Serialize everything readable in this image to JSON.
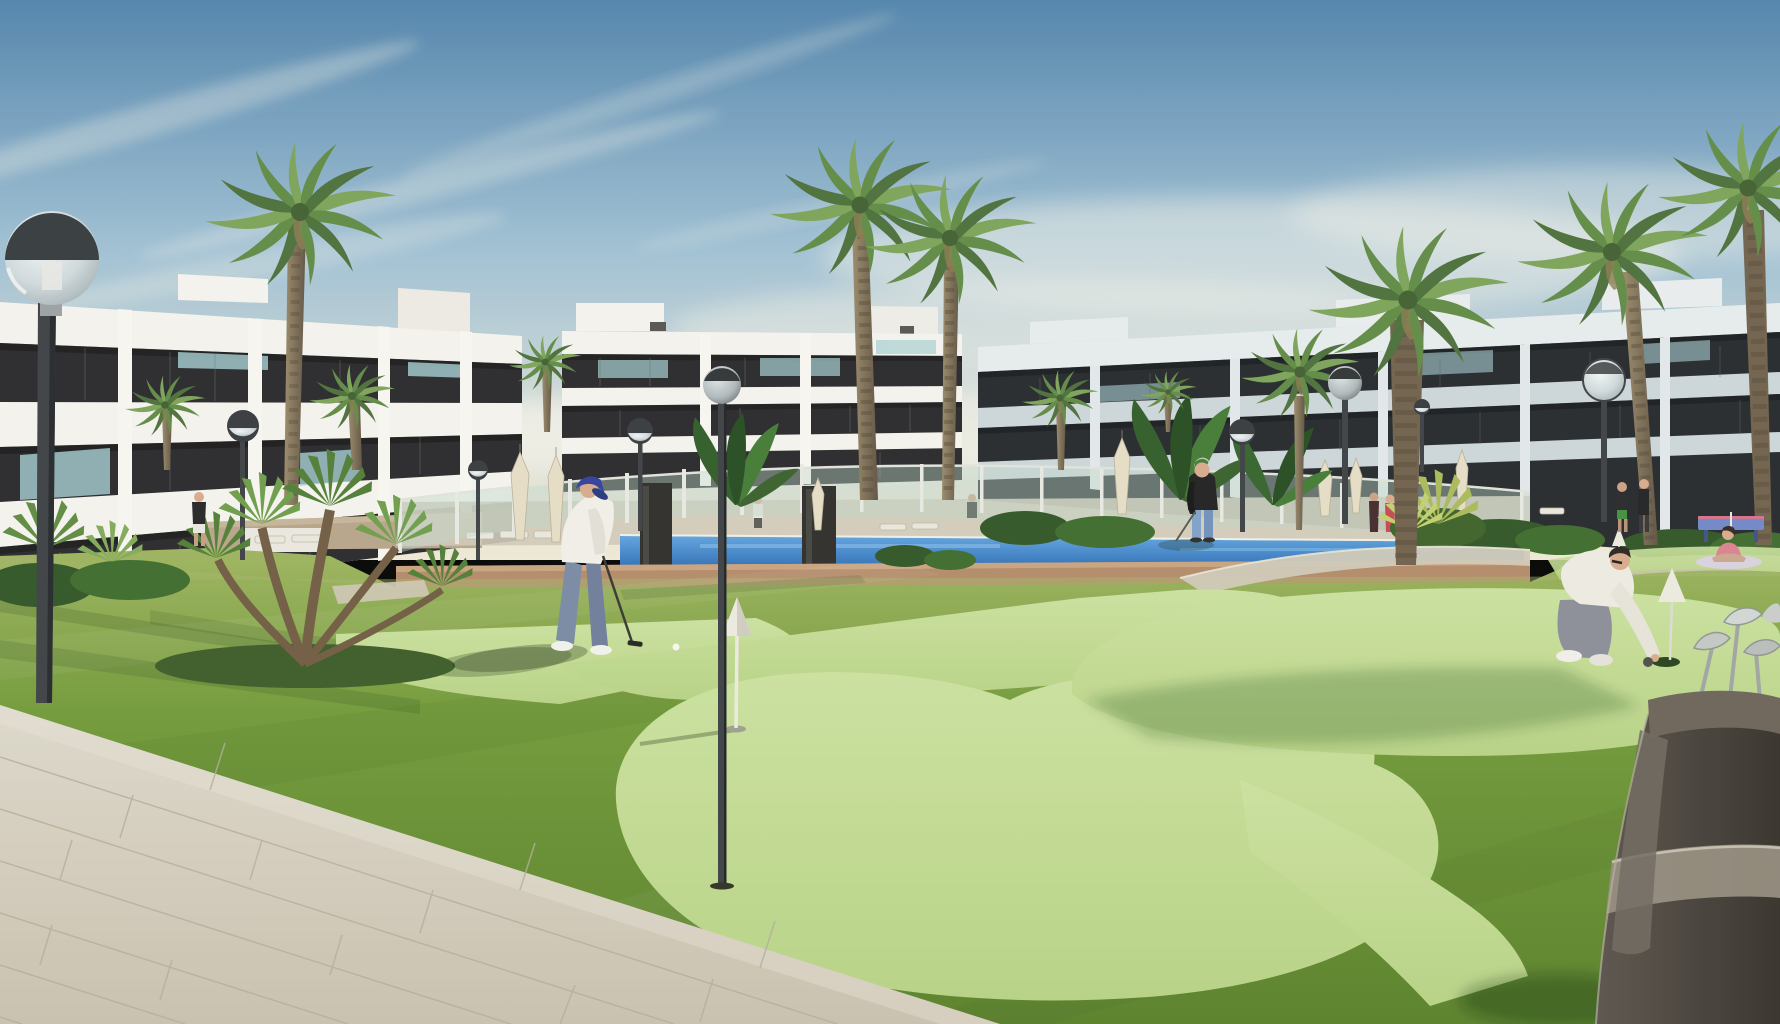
{
  "scene": {
    "kind": "architectural-render",
    "subject": "modern white apartment complex with communal putting green, pool area, palm trees and residents playing golf",
    "time_of_day": "late afternoon, clear sky"
  },
  "palette": {
    "sky_top": "#4f82ab",
    "sky_mid": "#9fc0d4",
    "sky_low": "#d9ded6",
    "sky_horizon": "#efe9d6",
    "cloud": "#f2f1e8",
    "building_white": "#f4f3ee",
    "building_right_light": "#ccd5da",
    "building_right_parapet": "#e6ebee",
    "glazing_dark": "#26262a",
    "glazing_deep": "#17181a",
    "balcony_teal": "#a5ced2",
    "grass_far": "#9db35e",
    "grass_mid": "#6f9836",
    "grass_near": "#577f28",
    "green_light_a": "#cbe19e",
    "green_light_b": "#b6d284",
    "pool_top": "#5fa2de",
    "pool_deep": "#2a6cb6",
    "deck_terracotta": "#b28a68",
    "path_light": "#d0c9b8",
    "pavement_far": "#ddd8cb",
    "pavement_near": "#c9c0ae",
    "tile_joint": "#b4ab99",
    "fence_glass": "#bed7c8",
    "fence_post": "#e6e8e2",
    "shower_slab": "#2c2b28",
    "trunk": "#83745a",
    "trunk_dark": "#5e5140",
    "frond_dark": "#4a6e38",
    "frond_mid": "#5f8a44",
    "frond_light": "#7ba357",
    "hedge": "#2e5423",
    "lamp_metal": "#3b3f42",
    "lamp_chrome": "#dfe5e8",
    "umbrella": "#e6ddc6",
    "skin": "#d7a98b",
    "golfer_shirt": "#f1efe8",
    "golfer_pants": "#7888a3",
    "golfer_cap_navy": "#2f3f9a",
    "bystander_top_black": "#1e1e20",
    "bystander_jeans": "#7fa0c8",
    "hair_gray": "#c9c7c2",
    "croucher_shirt": "#eceae2",
    "croucher_pants": "#8a8d96",
    "yoga_pink": "#d9808f",
    "tabletennis_blue": "#6f86c8",
    "tabletennis_pink": "#d4708e",
    "bag_dark": "#46403a",
    "bag_stripe": "#968d7f",
    "club_steel": "#c3c8c6",
    "cone_white": "#eceadf",
    "ball_white": "#f7f7f2",
    "stone_wall": "#b7a489",
    "shadow_green": "rgba(22,44,14,0.22)"
  },
  "objects": {
    "buildings": [
      {
        "id": "apartment-block-left",
        "floors": 3,
        "style": "white slab facades, dark glazing bands, roof terraces with teal glass"
      },
      {
        "id": "apartment-block-center",
        "floors": 3,
        "style": "white slab facades, dark glazing bands, penthouse boxes"
      },
      {
        "id": "apartment-block-right",
        "floors": 3,
        "style": "cool-toned slab facades in shade, dark glazing bands"
      }
    ],
    "vegetation": {
      "tall_palms": 9,
      "small_palms": 4,
      "foreground_palmetto_cluster": 1,
      "banana_plant_clumps": 3,
      "hedge_mounds": 12
    },
    "street_lamps": {
      "count": 9,
      "type": "globe on dark pole",
      "variants": [
        "dark-cap glass globe",
        "chrome sphere"
      ]
    },
    "pool_area": {
      "glass_fence": true,
      "closed_umbrellas": 7,
      "sun_loungers": 8,
      "shower_slabs": 2,
      "water_visible": true,
      "deck": "terracotta"
    },
    "putting_green": {
      "light_green_shapes": 5,
      "pins_with_cone_toppers": 3,
      "holes": 2,
      "golf_ball": 1
    },
    "people": [
      {
        "id": "golfer-putting",
        "description": "man in navy cap, white polo, grey trousers putting",
        "position": "center-left"
      },
      {
        "id": "standing-golfer",
        "description": "grey-haired man in black top and jeans with putter",
        "position": "center-right"
      },
      {
        "id": "crouching-golfer",
        "description": "man in white tee and grey trousers placing ball at hole",
        "position": "right"
      },
      {
        "id": "bystander-shorts",
        "description": "person in black tee and white shorts near left building",
        "position": "left"
      },
      {
        "id": "pool-pair",
        "description": "two people standing by pool fence",
        "position": "right of pool"
      },
      {
        "id": "fence-women",
        "description": "two women at the glass fence",
        "position": "center-right"
      },
      {
        "id": "yoga-person",
        "description": "woman seated on mat",
        "position": "far right lawn"
      }
    ],
    "equipment": [
      "golf-bag-with-clubs-foreground-right",
      "table-tennis-table-far-right"
    ],
    "ground": [
      "tiled-walkway-bottom-left",
      "lawn",
      "putting-green-shapes"
    ]
  }
}
